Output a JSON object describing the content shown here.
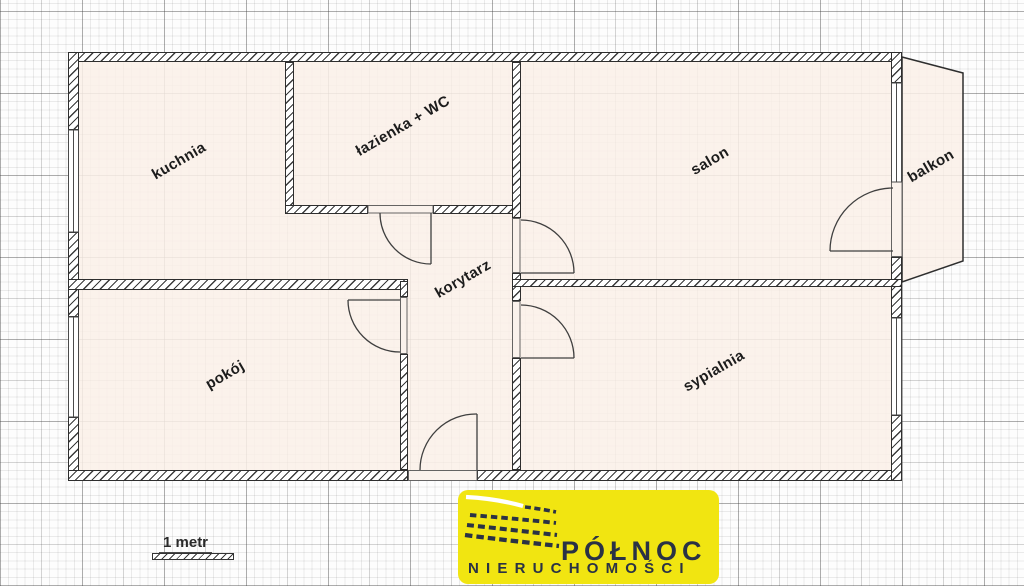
{
  "plan": {
    "rooms": {
      "kuchnia": "kuchnia",
      "lazienka": "łazienka + WC",
      "salon": "salon",
      "balkon": "balkon",
      "korytarz": "korytarz",
      "pokoj": "pokój",
      "sypialnia": "sypialnia"
    },
    "scale_label": "1 metr"
  },
  "logo": {
    "title": "PÓŁNOC",
    "subtitle": "NIERUCHOMOŚCI",
    "colors": {
      "background": "#F1E511",
      "text": "#2A3245",
      "swoosh": "#FFFFFF"
    }
  },
  "colors": {
    "room_fill": "#FAF1EA",
    "wall_line": "#2E2E2E",
    "paper": "#FDFDFD"
  }
}
